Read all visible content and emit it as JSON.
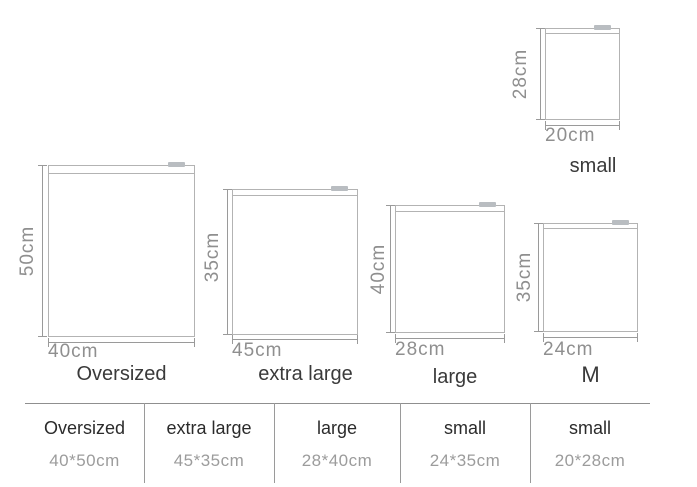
{
  "figure": {
    "bags": [
      {
        "name": "small",
        "width_label": "20cm",
        "height_label": "28cm"
      },
      {
        "name": "Oversized",
        "width_label": "40cm",
        "height_label": "50cm"
      },
      {
        "name": "extra large",
        "width_label": "45cm",
        "height_label": "35cm"
      },
      {
        "name": "large",
        "width_label": "28cm",
        "height_label": "40cm"
      },
      {
        "name": "M",
        "width_label": "24cm",
        "height_label": "35cm"
      }
    ]
  },
  "size_table": {
    "columns": [
      {
        "name": "Oversized",
        "size": "40*50cm"
      },
      {
        "name": "extra large",
        "size": "45*35cm"
      },
      {
        "name": "large",
        "size": "28*40cm"
      },
      {
        "name": "small",
        "size": "24*35cm"
      },
      {
        "name": "small",
        "size": "20*28cm"
      }
    ]
  },
  "colors": {
    "bag_border": "#b3b3b3",
    "zipper_tab": "#b9bdc1",
    "dimension_line": "#9a9a9a",
    "dimension_text": "#8f8f8f",
    "name_text": "#3a3a3a",
    "table_line": "#9a9a9a",
    "table_name_text": "#2b2b2b",
    "table_size_text": "#9c9c9c"
  }
}
